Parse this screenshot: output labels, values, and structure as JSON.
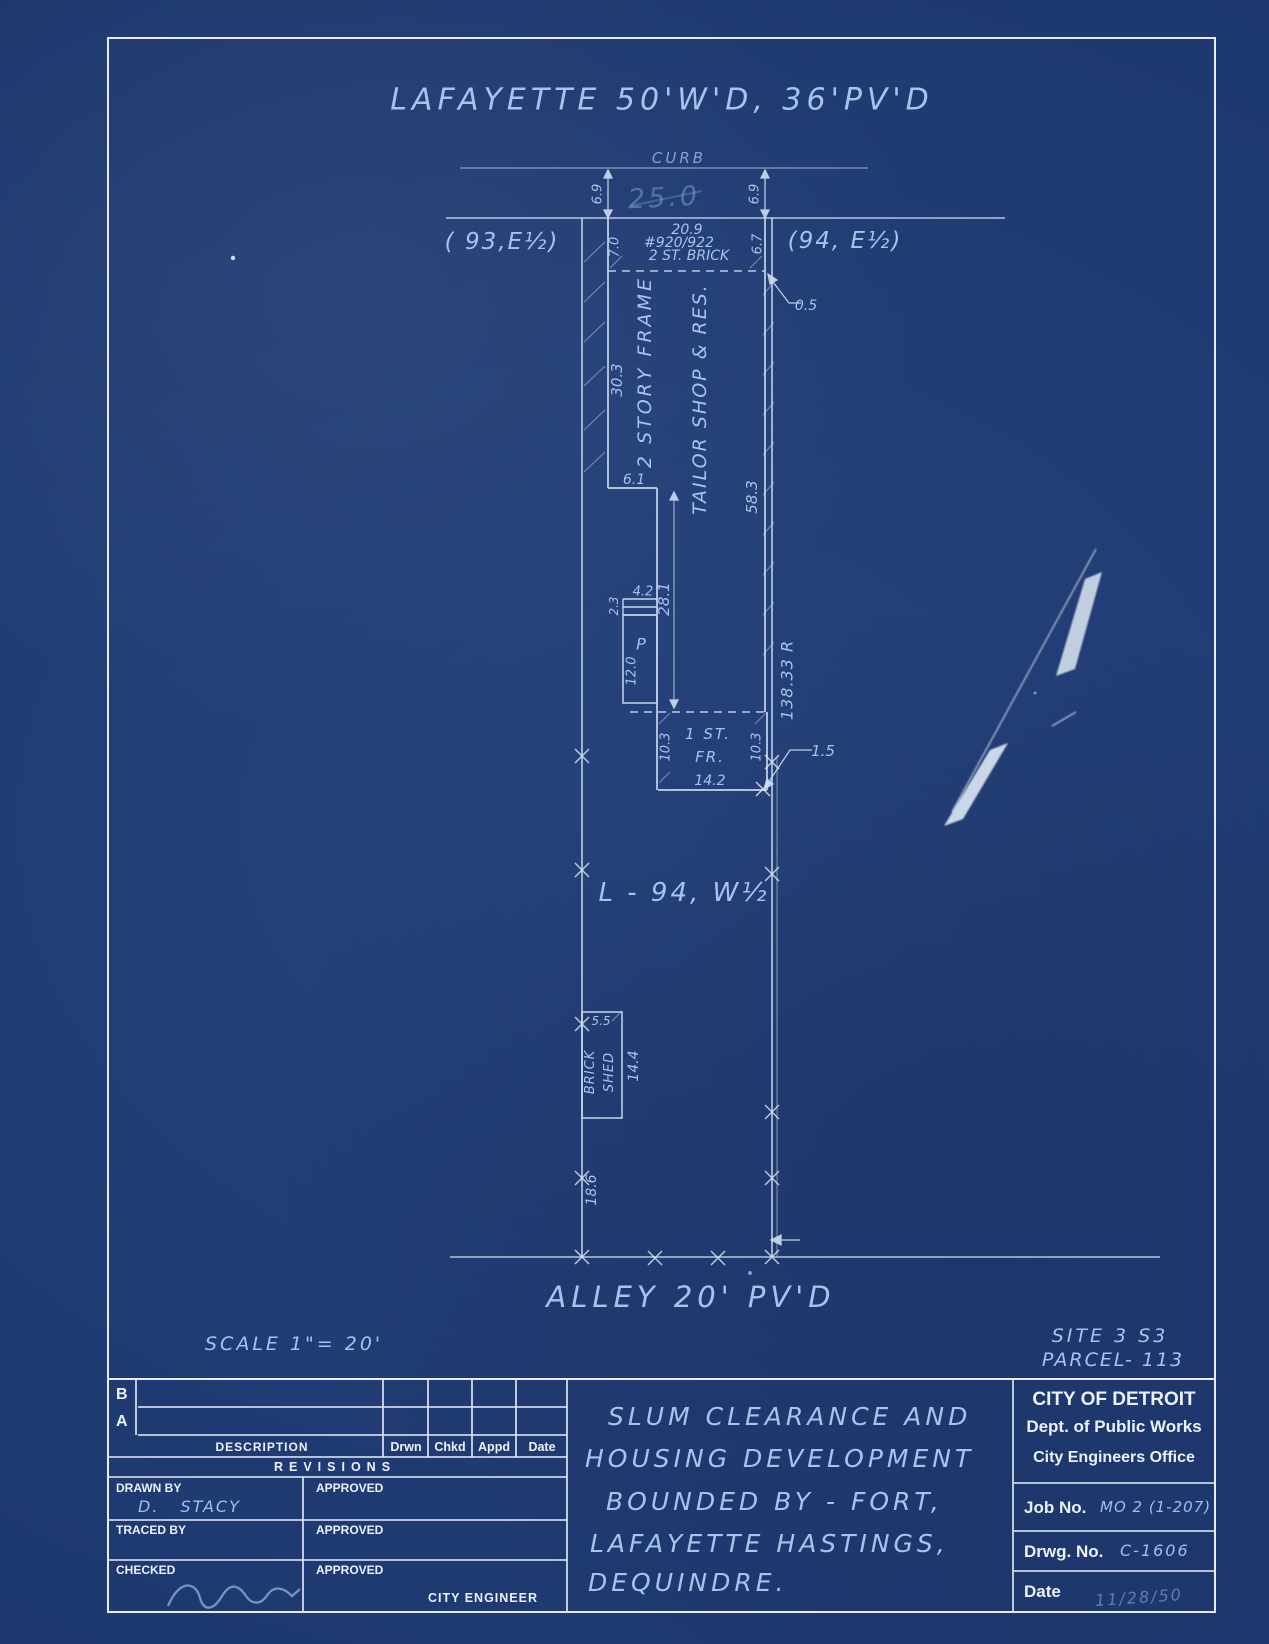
{
  "colors": {
    "paper_blue": "#203d78",
    "line_white": "#dbe6f6",
    "hand_ink": "#a6c4ec",
    "pencil_faint": "#8fb4e2",
    "printed_white": "#ecf1fb"
  },
  "header": {
    "street_label": "LAFAYETTE 50'W'D, 36'PV'D",
    "curb_label": "CURB"
  },
  "plan": {
    "lot_width_pencil": "25.0",
    "dim_curb_left": "6.9",
    "dim_curb_right": "6.9",
    "parcel_west": "( 93,E½)",
    "parcel_east": "(94, E½)",
    "bldg_width": "20.9",
    "house_number": "#920/922",
    "bldg_type_front": "2  ST.  BRICK",
    "dim_front_left": "7.0",
    "dim_front_right": "6.7",
    "dim_offset": "0.5",
    "dim_west_wall": "30.3",
    "bldg_frame": "2 STORY FRAME",
    "bldg_use": "TAILOR SHOP & RES.",
    "dim_east_wall": "58.3",
    "dim_step": "6.1",
    "dim_mid": "28.1",
    "dim_steps_width": "4.2",
    "dim_steps_depth": "2.3",
    "porch_label": "P",
    "dim_porch": "12.0",
    "dim_lot_depth": "138.33 R",
    "dim_rear_left": "10.3",
    "dim_rear_right": "10.3",
    "rear_bldg_line1": "1 ST.",
    "rear_bldg_line2": "FR.",
    "dim_rear_width": "14.2",
    "dim_rear_offset": "1.5",
    "lot_label": "L - 94, W½",
    "shed_dim_width": "5.5",
    "shed_line1": "BRICK",
    "shed_line2": "SHED",
    "shed_dim_depth": "14.4",
    "dim_rear_lot": "18.6",
    "alley_label": "ALLEY  20'  PV'D"
  },
  "footer": {
    "scale_label": "SCALE  1\"= 20'",
    "site_label": "SITE 3 S3",
    "parcel_label": "PARCEL- 113"
  },
  "titleblock": {
    "revisions": {
      "row_b": "B",
      "row_a": "A",
      "col_description": "DESCRIPTION",
      "col_drwn": "Drwn",
      "col_chkd": "Chkd",
      "col_appd": "Appd",
      "col_date": "Date",
      "title": "REVISIONS"
    },
    "signatures": {
      "drawn_by_label": "DRAWN BY",
      "drawn_by_value": "D.  STACY",
      "traced_by_label": "TRACED BY",
      "checked_label": "CHECKED",
      "approved_label_1": "APPROVED",
      "approved_label_2": "APPROVED",
      "approved_label_3": "APPROVED",
      "city_engineer_label": "CITY ENGINEER"
    },
    "project": {
      "line1": "SLUM CLEARANCE AND",
      "line2": "HOUSING DEVELOPMENT",
      "line3": "BOUNDED BY - FORT,",
      "line4": "LAFAYETTE HASTINGS,",
      "line5": "DEQUINDRE."
    },
    "agency": {
      "name": "CITY OF DETROIT",
      "dept": "Dept. of Public Works",
      "office": "City Engineers Office",
      "job_no_label": "Job No.",
      "job_no_value": "MO 2 (1-207)",
      "drwg_no_label": "Drwg. No.",
      "drwg_no_value": "C-1606",
      "date_label": "Date",
      "date_value": "11/28/50"
    }
  }
}
